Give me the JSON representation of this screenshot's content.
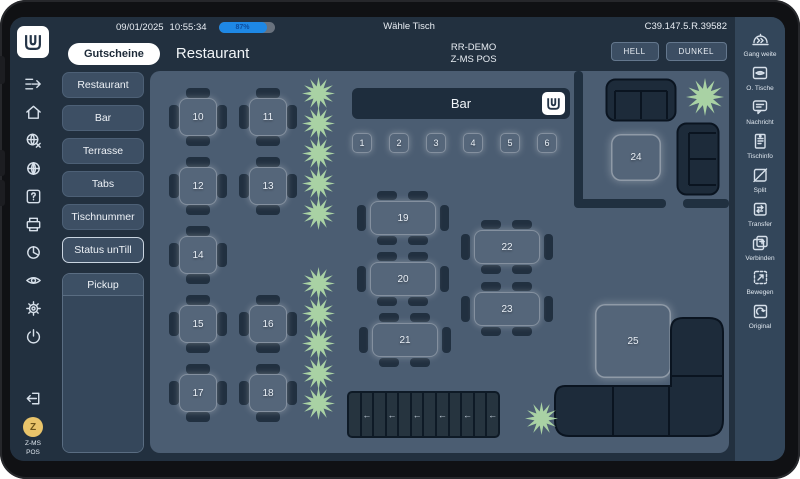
{
  "statusbar": {
    "date": "09/01/2025",
    "time": "10:55:34",
    "battery": "87%",
    "title": "Wähle Tisch",
    "terminal_code": "C39.147.5.R.39582"
  },
  "header": {
    "gutscheine": "Gutscheine",
    "title": "Restaurant",
    "station_line1": "RR-DEMO",
    "station_line2": "Z-MS POS",
    "theme_light": "HELL",
    "theme_dark": "DUNKEL"
  },
  "left_rail": {
    "avatar": "Z",
    "station_line1": "Z-MS",
    "station_line2": "POS"
  },
  "left_menu": {
    "areas": [
      "Restaurant",
      "Bar",
      "Terrasse",
      "Tabs",
      "Tischnummer",
      "Status unTill"
    ],
    "pickup": "Pickup"
  },
  "floor": {
    "bar": {
      "label": "Bar",
      "seats": [
        "1",
        "2",
        "3",
        "4",
        "5",
        "6"
      ]
    },
    "square_tables": [
      "10",
      "11",
      "12",
      "13",
      "14",
      "15",
      "16",
      "17",
      "18"
    ],
    "rect_tables": [
      "19",
      "20",
      "21",
      "22",
      "23"
    ],
    "lounge_tables": [
      "24",
      "25"
    ],
    "arrow": "←"
  },
  "right_rail": {
    "items": [
      {
        "label": "Gang weite"
      },
      {
        "label": "O. Tische"
      },
      {
        "label": "Nachricht"
      },
      {
        "label": "Tischinfo"
      },
      {
        "label": "Split"
      },
      {
        "label": "Transfer"
      },
      {
        "label": "Verbinden"
      },
      {
        "label": "Bewegen"
      },
      {
        "label": "Original"
      }
    ]
  },
  "colors": {
    "accent_blue": "#1e88e5",
    "plant_green": "#a9d2a4",
    "floor": "#4b5d72",
    "dark_navy": "#22303f"
  }
}
